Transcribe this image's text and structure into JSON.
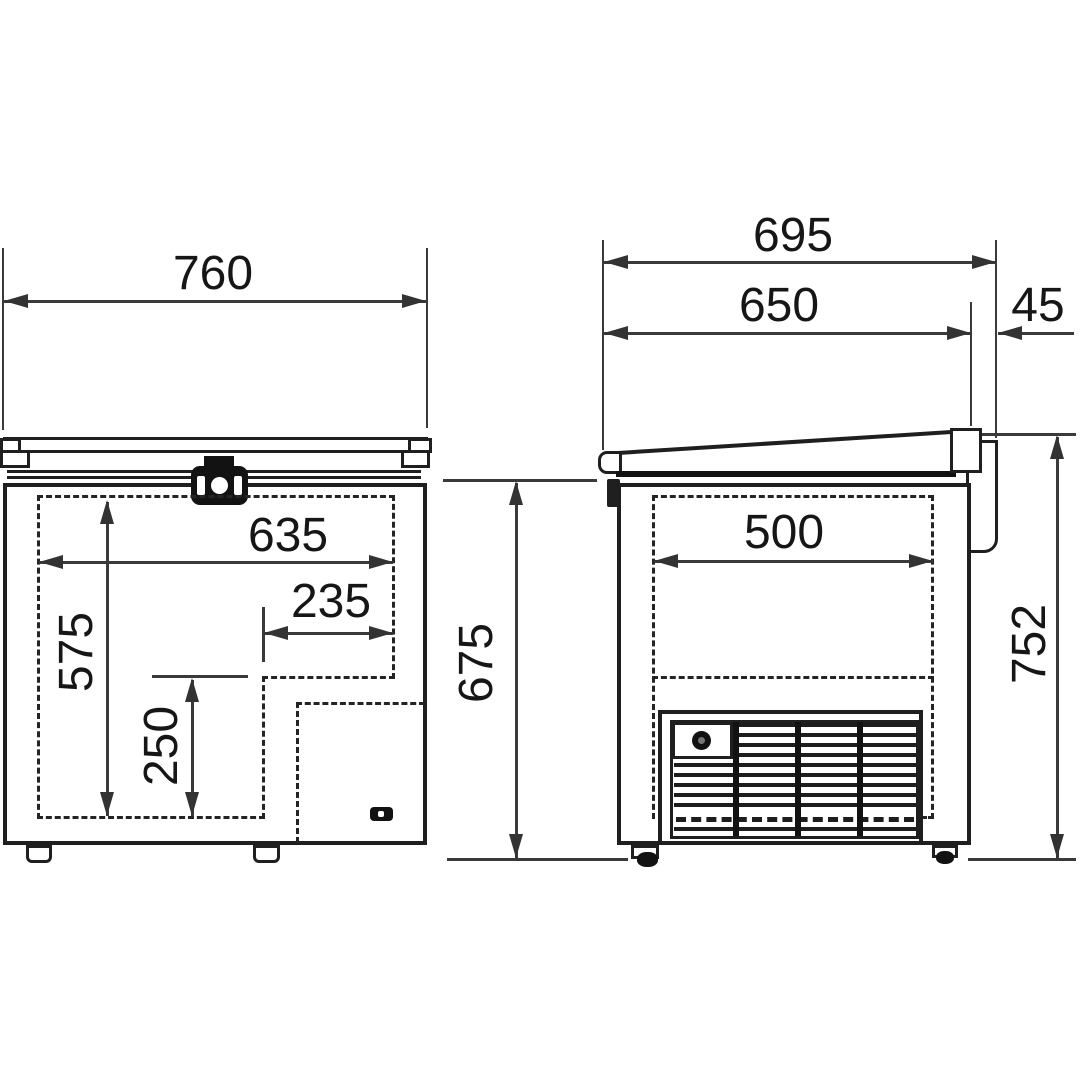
{
  "dimensions": {
    "front": {
      "overall_width": "760",
      "inner_width": "635",
      "step_width": "235",
      "inner_depth": "575",
      "step_depth": "250",
      "body_height": "675"
    },
    "side": {
      "overall_depth": "695",
      "body_depth": "650",
      "hinge_protrusion": "45",
      "inner_width": "500",
      "overall_height": "752"
    }
  },
  "colors": {
    "object_line": "#1f1f1f",
    "dimension_line": "#3a3a3a",
    "label_text": "#161616",
    "background": "#ffffff"
  }
}
